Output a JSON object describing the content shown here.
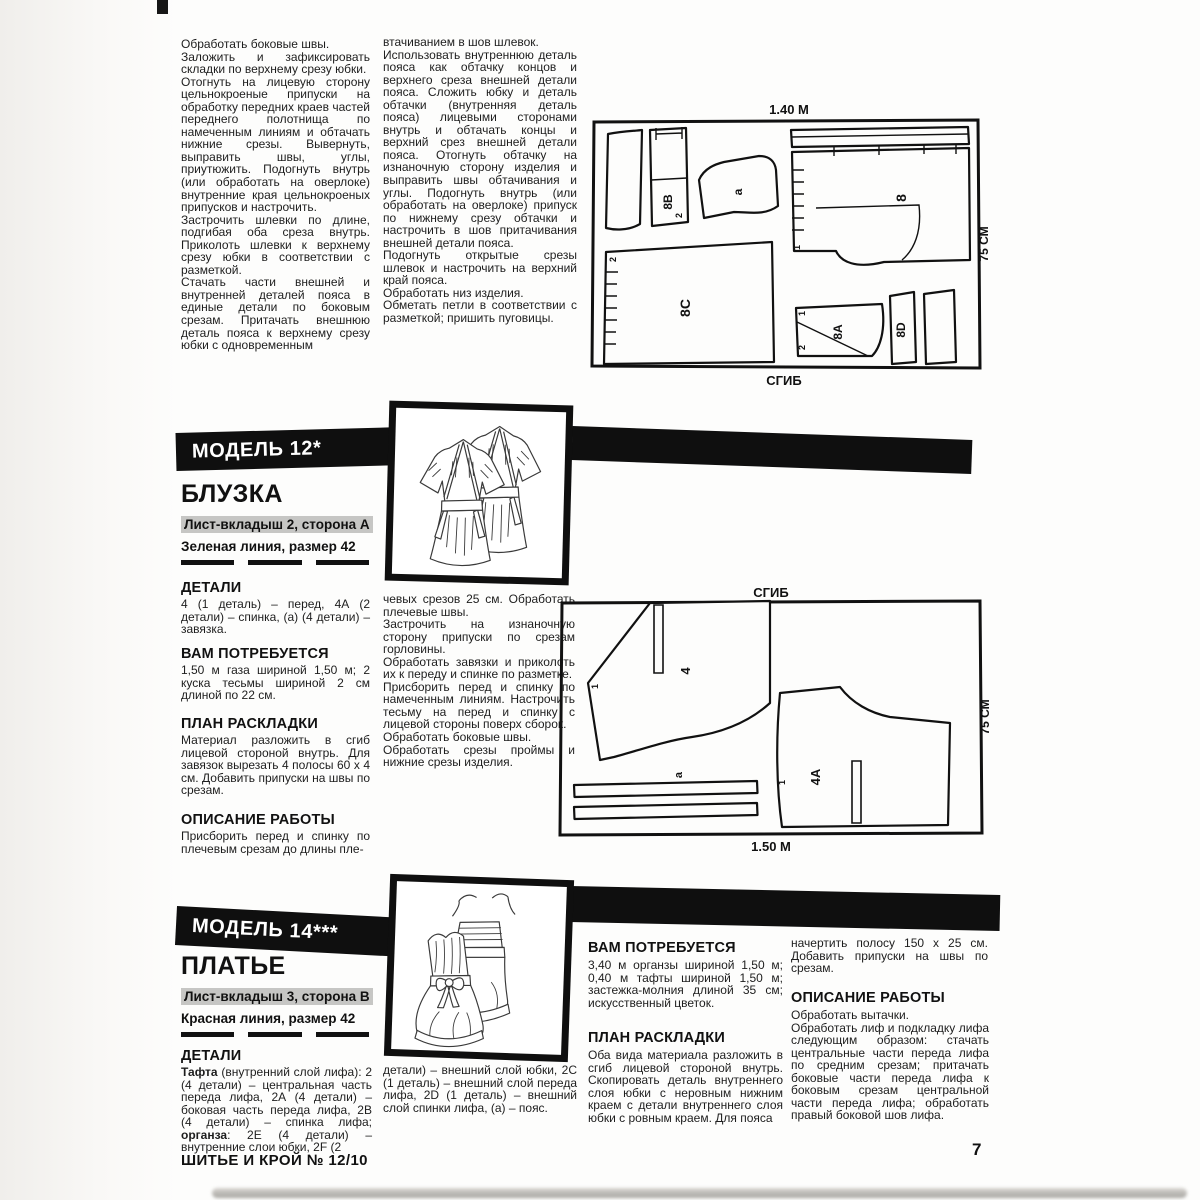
{
  "page": {
    "number": "7",
    "footer": "ШИТЬЕ И КРОЙ  № 12/10"
  },
  "top_article": {
    "col1": [
      "Обработать боковые швы.",
      "Заложить и зафиксировать складки по верхнему срезу юбки.",
      "Отогнуть на лицевую сторону цельнокроеные припуски на обработку передних краев частей переднего полотнища по намеченным линиям и обтачать нижние срезы. Вывернуть, выправить швы, углы, приутюжить. Подогнуть внутрь (или обработать на оверлоке) внутренние края цельнокроеных припусков и настрочить.",
      "Застрочить шлевки по длине, подгибая оба среза внутрь. Приколоть шлевки к верхнему срезу юбки в соответствии с разметкой.",
      "Стачать части внешней и внутренней деталей пояса в единые детали по боковым срезам. Притачать внешнюю деталь пояса к верхнему срезу юбки с одновременным"
    ],
    "col2": [
      "втачиванием в шов шлевок.",
      "Использовать внутреннюю деталь пояса как обтачку концов и верхнего среза внешней детали пояса. Сложить юбку и деталь обтачки (внутренняя деталь пояса) лицевыми сторонами внутрь и обтачать концы и верхний срез внешней детали пояса. Отогнуть обтачку на изнаночную сторону изделия и выправить швы обтачивания и углы. Подогнуть внутрь (или обработать на оверлоке) припуск по нижнему срезу обтачки и настрочить в шов притачивания внешней детали пояса.",
      "Подогнуть открытые срезы шлевок и настрочить на верхний край пояса.",
      "Обработать низ изделия.",
      "Обметать петли в соответствии с разметкой; пришить пуговицы."
    ]
  },
  "diagram1": {
    "top_label": "1.40 M",
    "side_label": "75 СМ",
    "bottom_label": "СГИБ",
    "labels": {
      "p8b": "8B",
      "pa": "а",
      "p8": "8",
      "p8c": "8C",
      "p8a": "8A",
      "p8d": "8D",
      "n1": "1",
      "n2": "2",
      "n1b": "1",
      "n2b": "2",
      "n2c": "2"
    }
  },
  "model12": {
    "band": "МОДЕЛЬ 12*",
    "garment": "БЛУЗКА",
    "sheet": "Лист-вкладыш 2, сторона А",
    "line_info": "Зеленая линия, размер 42",
    "details_heading": "ДЕТАЛИ",
    "details_text": "4 (1 деталь) – перед, 4А (2 детали) – спинка, (а) (4 детали) – завязка.",
    "need_heading": "ВАМ ПОТРЕБУЕТСЯ",
    "need_text": "1,50 м газа шириной 1,50 м; 2 куска тесьмы шириной 2 см длиной по 22 см.",
    "layout_heading": "ПЛАН РАСКЛАДКИ",
    "layout_text": "Материал разложить в сгиб лицевой стороной внутрь. Для завязок вырезать 4 полосы 60 х 4 см. Добавить припуски на швы по срезам.",
    "work_heading": "ОПИСАНИЕ РАБОТЫ",
    "work_text": "Присборить перед и спинку по плечевым срезам до длины пле-",
    "work_cont": [
      "чевых срезов 25 см. Обработать плечевые швы.",
      "Застрочить на изнаночную сторону припуски по срезам горловины.",
      "Обработать завязки и приколоть их к переду и спинке по разметке.",
      "Присборить перед и спинку по намеченным линиям. Настрочить тесьму на перед и спинку с лицевой стороны поверх сборок.",
      "Обработать боковые швы.",
      "Обработать срезы проймы и нижние срезы изделия."
    ]
  },
  "diagram2": {
    "top_label": "СГИБ",
    "side_label": "75 СМ",
    "bottom_label": "1.50 M",
    "labels": {
      "p4": "4",
      "p4a": "4А",
      "pa": "а",
      "n1": "1",
      "n1b": "1"
    }
  },
  "model14": {
    "band": "МОДЕЛЬ 14***",
    "garment": "ПЛАТЬЕ",
    "sheet": "Лист-вкладыш 3, сторона В",
    "line_info": "Красная линия, размер 42",
    "details_heading": "ДЕТАЛИ",
    "details_bold1": "Тафта",
    "details_left1": " (внутренний слой лифа): 2 (4 детали) – центральная часть переда лифа, 2А (4 детали) – боковая часть переда лифа, 2В (4 детали) – спинка лифа; ",
    "details_bold2": "органза",
    "details_left2": ": 2Е (4 детали) – внутренние слои юбки, 2F (2",
    "details_mid": "детали) – внешний слой юбки, 2С (1 деталь) – внешний слой переда лифа, 2D (1 деталь) – внешний слой спинки лифа, (а) – пояс.",
    "need_heading": "ВАМ ПОТРЕБУЕТСЯ",
    "need_text": "3,40 м органзы шириной 1,50 м; 0,40 м тафты шириной 1,50 м; застежка-молния длиной 35 см; искусственный цветок.",
    "layout_heading": "ПЛАН РАСКЛАДКИ",
    "layout_text": "Оба вида материала разложить в сгиб лицевой стороной внутрь. Скопировать деталь внутреннего слоя юбки с неровным нижним краем с детали внутреннего слоя юбки с ровным краем. Для пояса",
    "layout_cont": "начертить полосу 150 х 25 см. Добавить припуски на швы по срезам.",
    "work_heading": "ОПИСАНИЕ РАБОТЫ",
    "work_text": [
      "Обработать вытачки.",
      "Обработать лиф и подкладку лифа следующим образом: стачать центральные части переда лифа по средним срезам; притачать боковые части переда лифа к боковым срезам центральной части переда лифа; обработать правый боковой шов лифа."
    ]
  }
}
